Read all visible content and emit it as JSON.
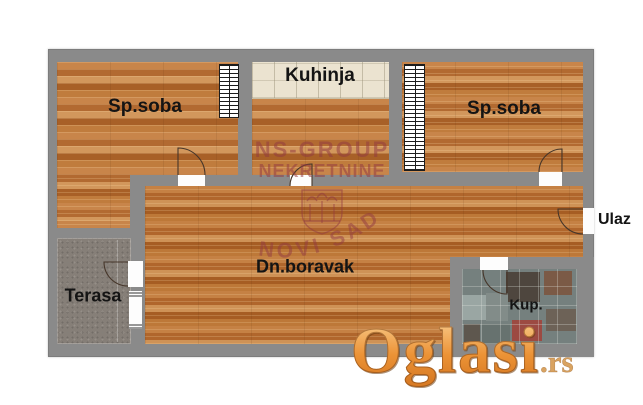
{
  "page": {
    "background": "#ffffff",
    "kind": "real-estate floor plan"
  },
  "floorplan": {
    "rooms": {
      "bedroom_left": {
        "label": "Sp.soba",
        "floor": "wood"
      },
      "kitchen": {
        "label": "Kuhinja",
        "floor": "wood with counter band"
      },
      "bedroom_right": {
        "label": "Sp.soba",
        "floor": "wood"
      },
      "living_room": {
        "label": "Dn.boravak",
        "floor": "wood"
      },
      "terrace": {
        "label": "Terasa",
        "floor": "concrete"
      },
      "bathroom": {
        "label": "Kup.",
        "floor": "tile"
      }
    },
    "entrance": {
      "label": "Ulaz"
    },
    "colors": {
      "wall": "#8a8a8a",
      "wood": "#c28044",
      "counter": "#ebe3d0",
      "terrace": "#867f78",
      "tile_base": "#75807e",
      "label_text": "#141414"
    }
  },
  "watermarks": {
    "agency": {
      "line1": "NS-GROUP",
      "line2": "NEKRETNINE",
      "arc": "NOVI SAD",
      "color": "#923a42"
    },
    "site": {
      "name": "Oglasi",
      "tld": ".rs",
      "color": "#ec9336"
    }
  }
}
